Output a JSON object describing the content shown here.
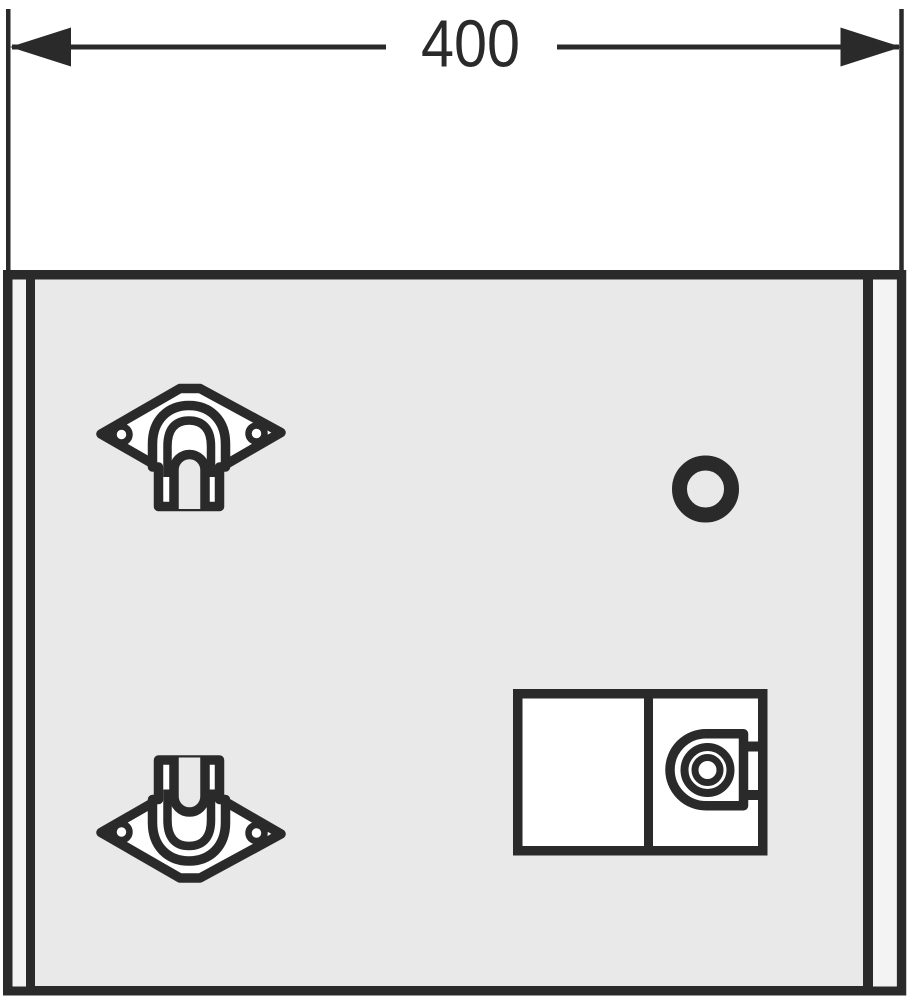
{
  "dimension": {
    "label": "400"
  },
  "colors": {
    "ink": "#2a2a2a",
    "panel": "#e9e9e9",
    "strip": "#f3f3f3",
    "white": "#ffffff",
    "bg": "#ffffff"
  },
  "parts": {
    "drawing": "technical-front-view-of-mounting-panel",
    "top_bracket": "hanger-bracket-hook-down",
    "bottom_bracket": "hanger-bracket-hook-up",
    "round_hole": "circular-hole",
    "lock_unit": "lock-box-with-cylinder"
  }
}
